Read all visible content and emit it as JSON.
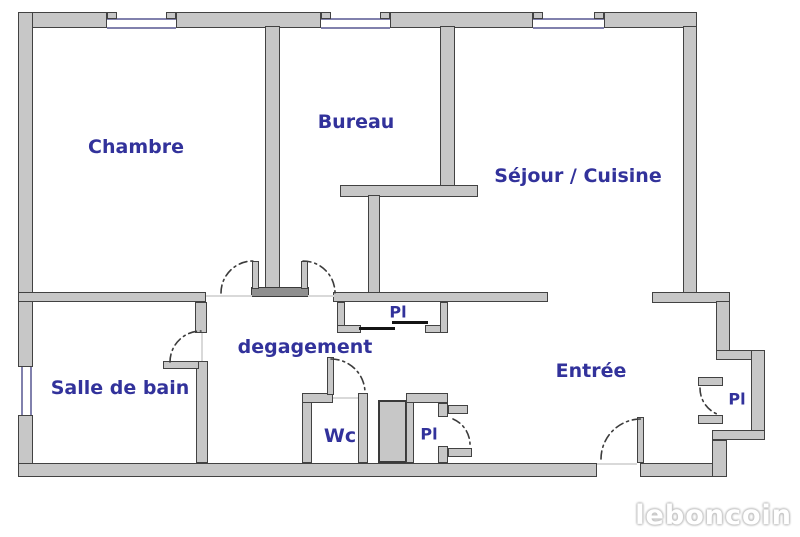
{
  "plan": {
    "type": "apartment-floor-plan",
    "rooms": [
      {
        "id": "chambre",
        "label": "Chambre"
      },
      {
        "id": "bureau",
        "label": "Bureau"
      },
      {
        "id": "sejour-cuisine",
        "label": "Séjour / Cuisine"
      },
      {
        "id": "salle-de-bain",
        "label": "Salle de bain"
      },
      {
        "id": "degagement",
        "label": "degagement"
      },
      {
        "id": "entree",
        "label": "Entrée"
      },
      {
        "id": "wc",
        "label": "Wc"
      }
    ],
    "closets": [
      {
        "id": "placard-hallway",
        "label": "Pl"
      },
      {
        "id": "placard-middle",
        "label": "Pl"
      },
      {
        "id": "placard-entry-right",
        "label": "Pl"
      }
    ],
    "features": {
      "windows_top": 3,
      "window_left": 1,
      "doors_with_swing_arcs": 7
    }
  },
  "watermark": {
    "text": "leboncoin"
  },
  "colors": {
    "background": "#ffffff",
    "wall_fill": "#c7c7c7",
    "wall_stroke": "#424242",
    "window_line": "#8181ad",
    "label_text": "#32329b",
    "door_arc": "#3c3c3c",
    "closet_slider": "#141414",
    "watermark_outline": "#c4c4c4"
  }
}
